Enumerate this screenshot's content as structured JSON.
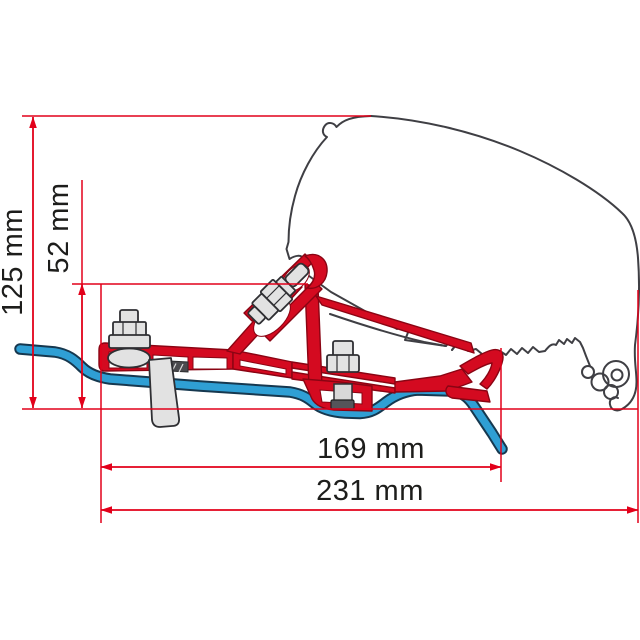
{
  "diagram": {
    "type": "technical-dimension-drawing",
    "subject": "Awning adapter bracket (red) mounted between van roof rail (blue) and awning case profile (grey outline), side cross-section",
    "dimensions": [
      {
        "name": "overall-height",
        "text": "125 mm",
        "value": 125,
        "unit": "mm",
        "orientation": "vertical"
      },
      {
        "name": "bracket-height",
        "text": "52 mm",
        "value": 52,
        "unit": "mm",
        "orientation": "vertical"
      },
      {
        "name": "bracket-length",
        "text": "169 mm",
        "value": 169,
        "unit": "mm",
        "orientation": "horizontal"
      },
      {
        "name": "overall-length",
        "text": "231 mm",
        "value": 231,
        "unit": "mm",
        "orientation": "horizontal"
      }
    ],
    "colors": {
      "dimension_lines": "#e2001a",
      "bracket": "#d40a20",
      "rail": "#2f9fd4",
      "profile_outline": "#3f3f44",
      "label_text": "#1d1d1b",
      "background": "#ffffff"
    },
    "parts": [
      "vehicle-awning-profile-outline",
      "roof-rail",
      "adapter-bracket",
      "left-mounting-bolt",
      "diagonal-clamp-bolt",
      "right-mounting-bolt",
      "rail-stud"
    ]
  }
}
